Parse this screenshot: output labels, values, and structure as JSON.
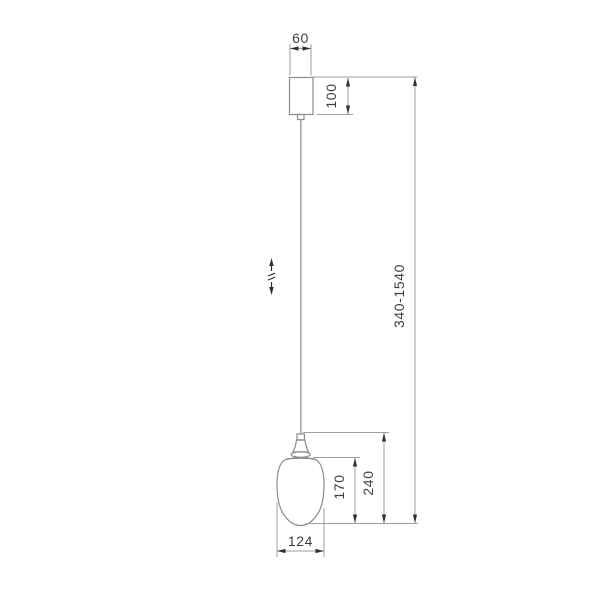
{
  "drawing": {
    "type": "technical dimension drawing",
    "subject": "pendant lamp with egg-shaped glass shade on adjustable cable",
    "labels": {
      "canopy_width_mm": "60",
      "canopy_height_mm": "100",
      "overall_height_mm": "340-1540",
      "shade_height_mm": "170",
      "fixture_height_mm": "240",
      "shade_width_mm": "124"
    },
    "icons": {
      "height_adjust": "up-down-arrow-with-break"
    },
    "colors": {
      "background": "#ffffff",
      "outline": "#8c8c8c",
      "cable": "#a6a6a6",
      "dimension": "#9e9e9e",
      "arrow": "#2f2f2f",
      "text": "#3f3f3f"
    }
  }
}
